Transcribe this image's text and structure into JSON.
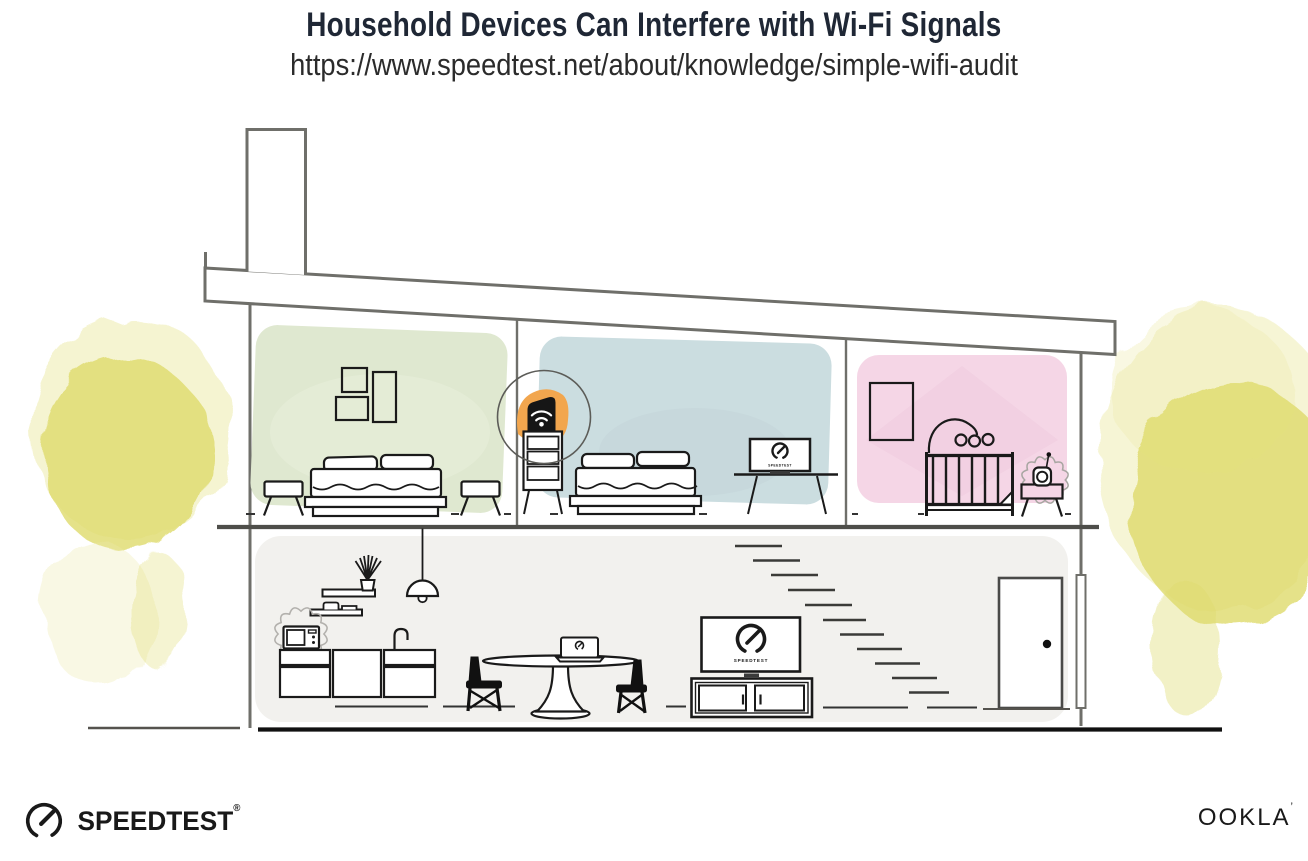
{
  "header": {
    "title": "Household Devices Can Interfere with Wi-Fi Signals",
    "url": "https://www.speedtest.net/about/knowledge/simple-wifi-audit"
  },
  "screens": {
    "bedroom_monitor_label": "SPEEDTEST",
    "tv_label": "SPEEDTEST"
  },
  "footer": {
    "speedtest_wordmark": "SPEEDTEST",
    "speedtest_reg_mark": "®",
    "ookla_wordmark": "OOKLA",
    "ookla_reg_mark": "’"
  },
  "colors": {
    "title_ink": "#1F2735",
    "ink": "#1A1A1A",
    "line_gray": "#6F6F6A",
    "room_green": "#DFE8D0",
    "room_blue": "#CBDDE0",
    "room_pink": "#F5D6E6",
    "lower_floor_gray": "#F2F1EE",
    "tree_yellow": "#DEDB6B",
    "tree_yellow_light": "#EDEBAC",
    "router_orange": "#F2A64E"
  }
}
